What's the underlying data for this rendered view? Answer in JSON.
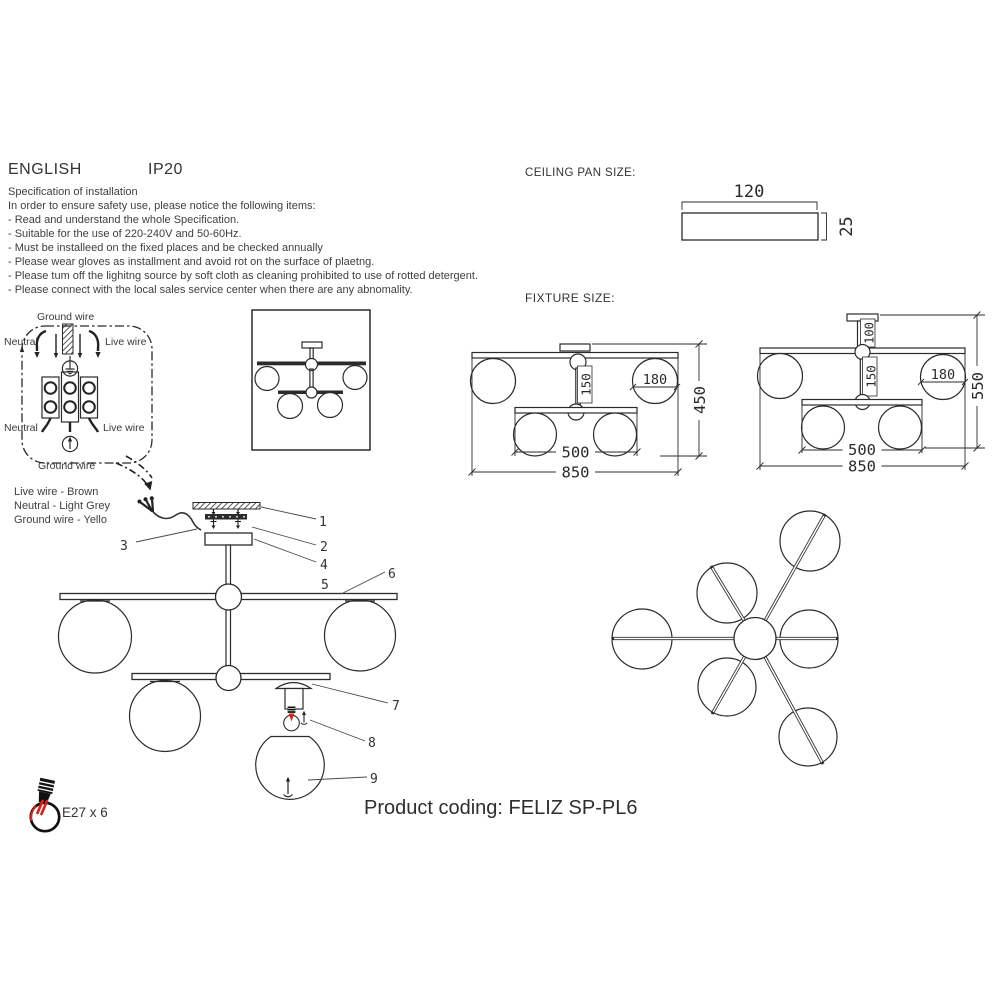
{
  "page": {
    "language": "ENGLISH",
    "ip_rating": "IP20"
  },
  "spec": {
    "title": "Specification of installation",
    "intro": "In order to ensure safety use, please notice the following items:",
    "items": [
      "- Read and understand the whole Specification.",
      "- Suitable for the use of 220-240V and 50-60Hz.",
      "- Must be installeed on the fixed places and be checked annually",
      "- Please wear gloves as installment and avoid rot on the surface of plaetng.",
      "- Please tum off the lighitng source by soft cloth as cleaning prohibited to use of rotted detergent.",
      "- Please connect with the local sales service center when there are any abnomality."
    ]
  },
  "ceiling_pan": {
    "label": "CEILING PAN  SIZE:",
    "width": "120",
    "height": "25"
  },
  "fixture": {
    "label": "FIXTURE SIZE:",
    "view1": {
      "overall_width": "850",
      "bar_width": "500",
      "stem_length": "150",
      "globe_diameter": "180",
      "overall_height": "450"
    },
    "view2": {
      "overall_width": "850",
      "bar_width": "500",
      "stem_length": "150",
      "top_stem_length": "100",
      "globe_diameter": "180",
      "overall_height": "550"
    }
  },
  "wiring": {
    "ground_top": "Ground wire",
    "neutral_top": "Neutral",
    "live_top": "Live wire",
    "neutral_bottom": "Neutral",
    "live_bottom": "Live wire",
    "ground_bottom": "Ground wire"
  },
  "wire_colors": {
    "live": "Live wire - Brown",
    "neutral": "Neutral - Light Grey",
    "ground": "Ground wire - Yello"
  },
  "parts": [
    "1",
    "2",
    "3",
    "4",
    "5",
    "6",
    "7",
    "8",
    "9"
  ],
  "footer": {
    "lamp_spec": "E27 x 6",
    "product_coding": "Product coding: FELIZ SP-PL6"
  },
  "colors": {
    "ink": "#2b2b2b",
    "text": "#3a3a3a",
    "red": "#da2318"
  }
}
